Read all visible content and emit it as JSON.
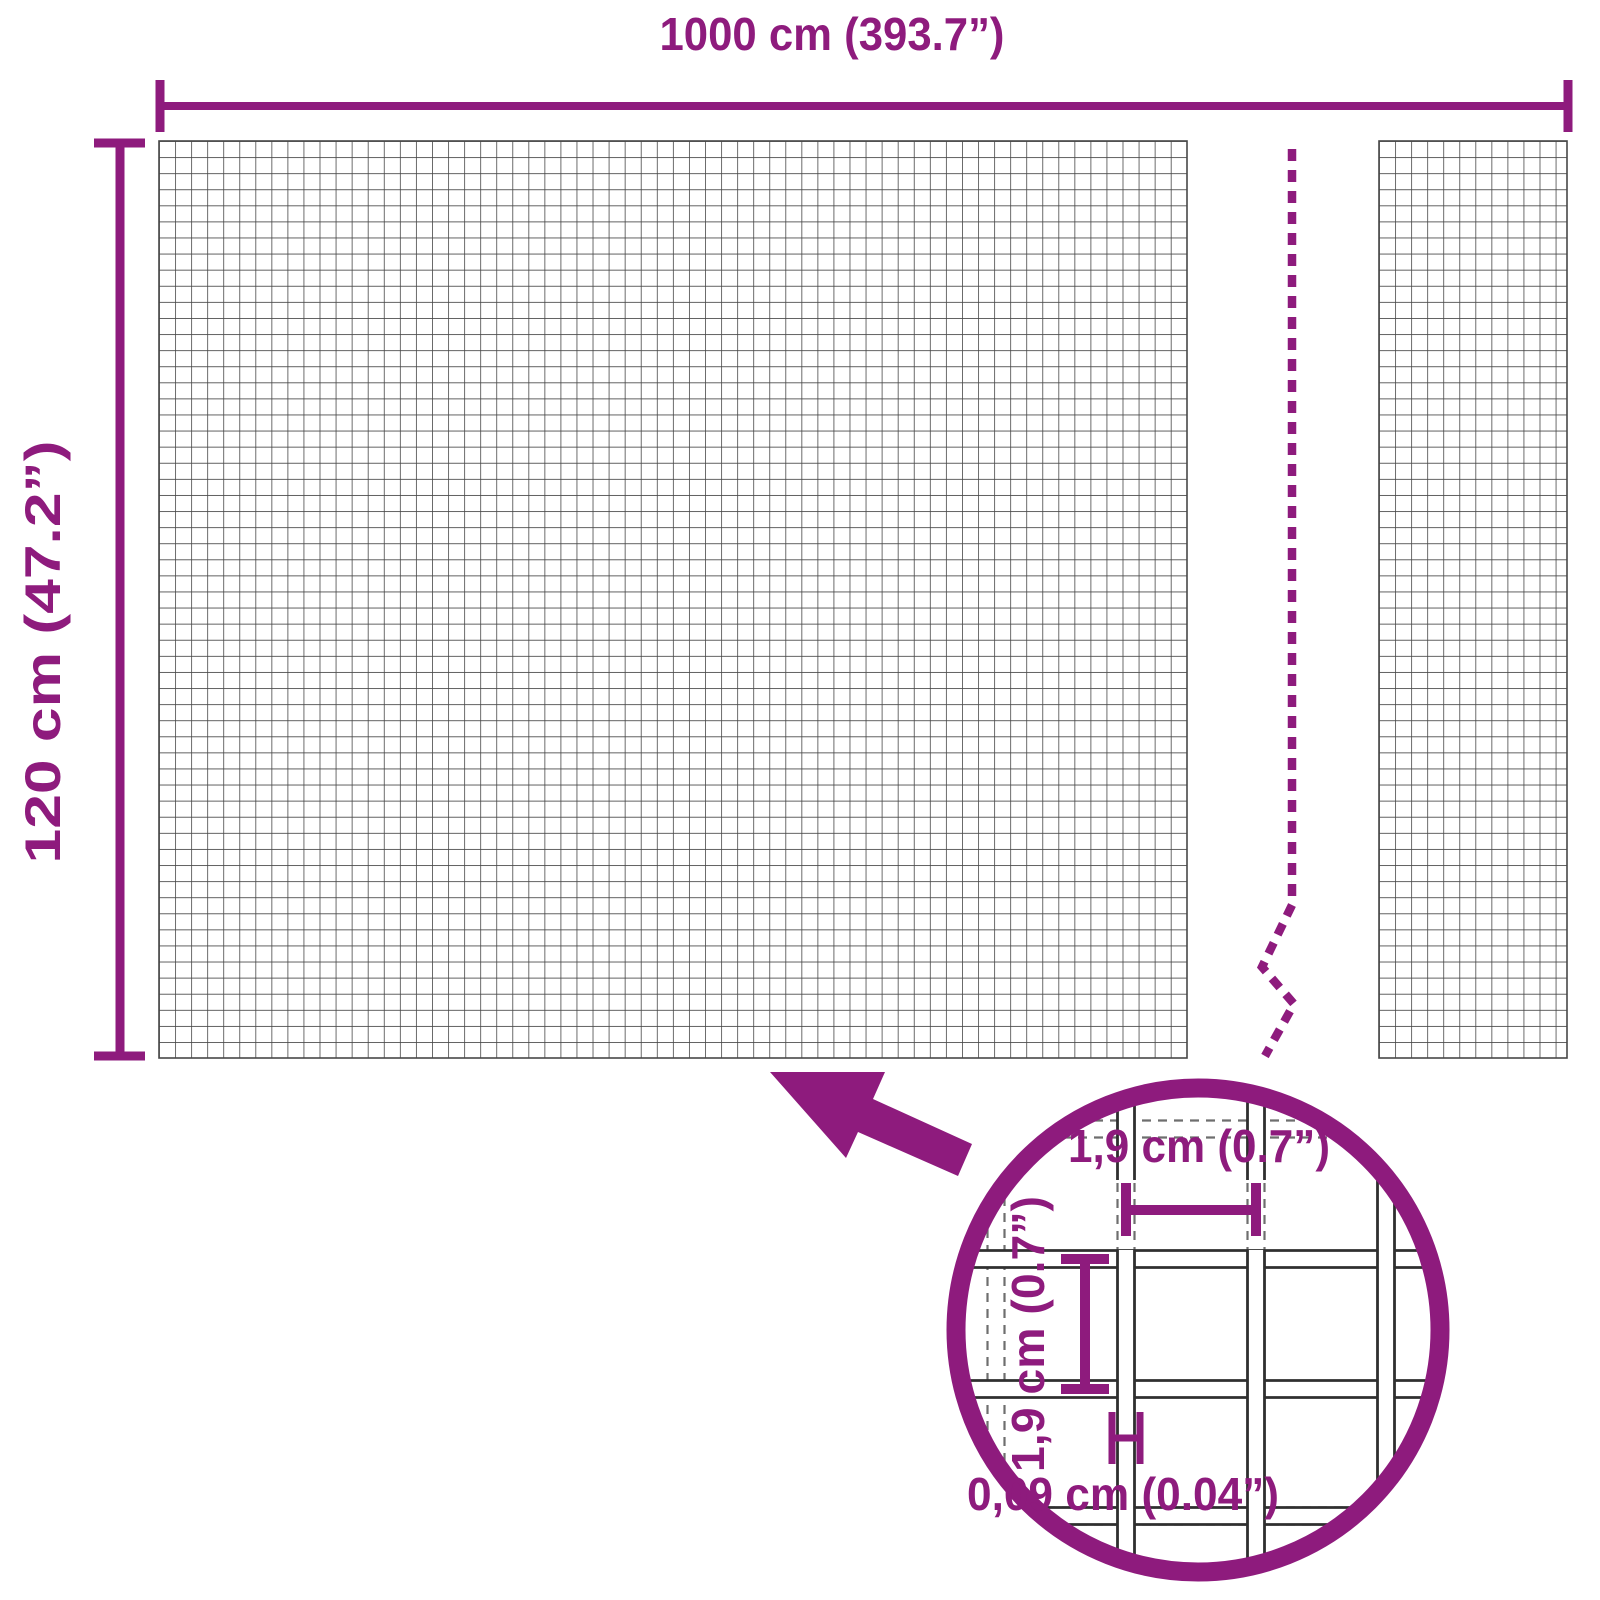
{
  "diagram": {
    "type": "product-dimension-diagram",
    "subject": "wire mesh panel"
  },
  "colors": {
    "accent": "#8E1B7D",
    "mesh_line": "#474747",
    "wire_outline": "#2f2f2f",
    "hidden_line": "#6e6e6e",
    "background": "#ffffff"
  },
  "overall": {
    "width_label": "1000 cm (393.7”)",
    "height_label": "120 cm (47.2”)"
  },
  "detail": {
    "cell_width_label": "1,9 cm (0.7”)",
    "cell_height_label": "1,9 cm (0.7”)",
    "wire_thickness_label": "0,09 cm (0.04”)"
  }
}
